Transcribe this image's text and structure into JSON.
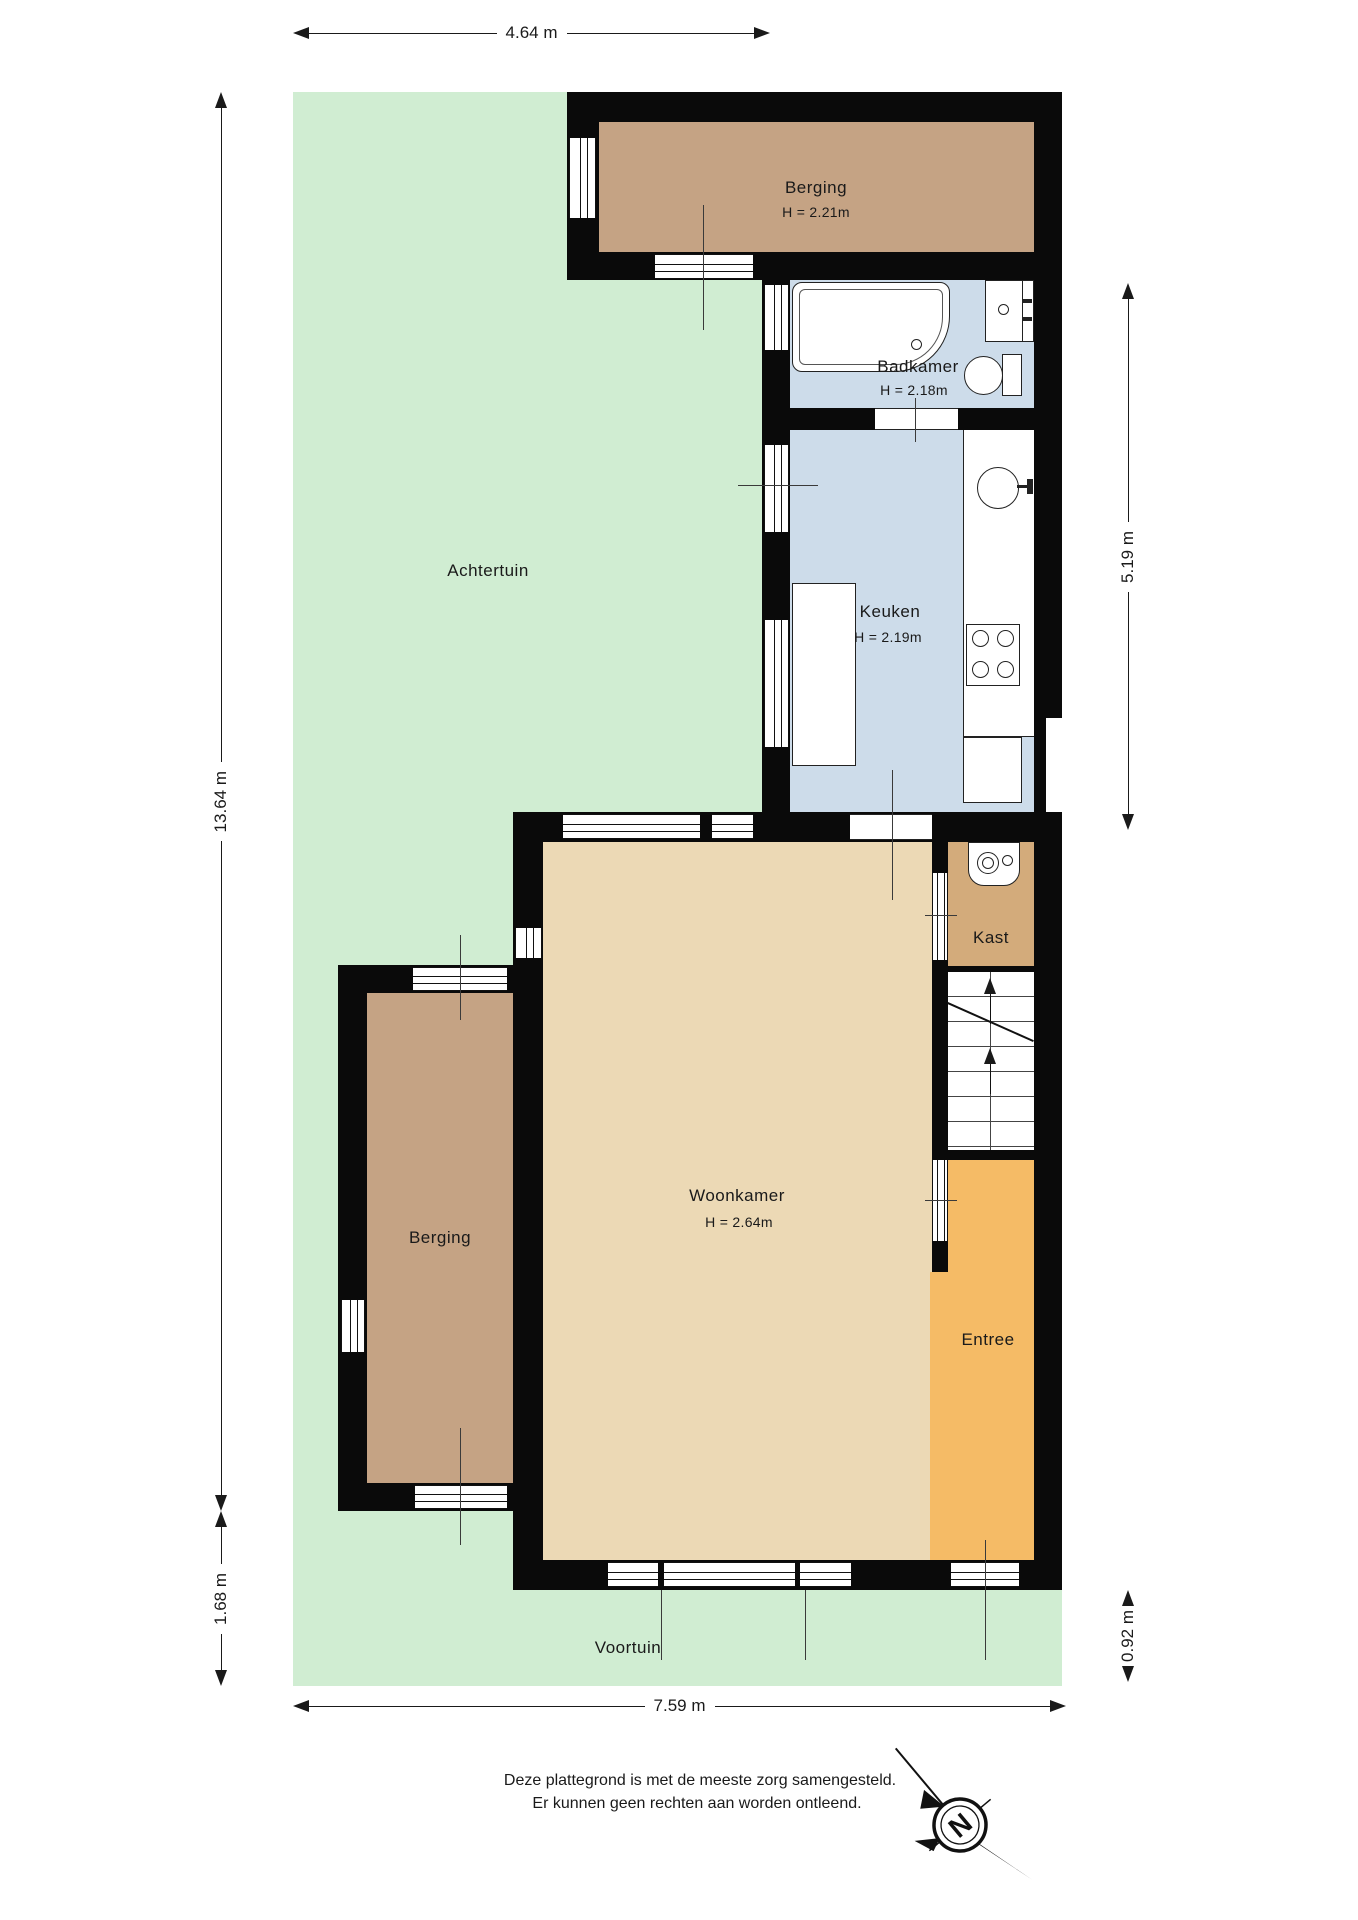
{
  "plan": {
    "rooms": {
      "berging_top": {
        "label": "Berging",
        "height": "H = 2.21m"
      },
      "badkamer": {
        "label": "Badkamer",
        "height": "H = 2.18m"
      },
      "keuken": {
        "label": "Keuken",
        "height": "H = 2.19m"
      },
      "achtertuin": {
        "label": "Achtertuin"
      },
      "woonkamer": {
        "label": "Woonkamer",
        "height": "H = 2.64m"
      },
      "kast": {
        "label": "Kast"
      },
      "berging_left": {
        "label": "Berging"
      },
      "entree": {
        "label": "Entree"
      },
      "voortuin": {
        "label": "Voortuin"
      }
    },
    "dimensions": {
      "top": "4.64 m",
      "left": "13.64 m",
      "left_bottom": "1.68 m",
      "right": "5.19 m",
      "right_bottom": "0.92 m",
      "bottom": "7.59 m"
    },
    "fixtures": [
      "bathtub",
      "washbasin",
      "toilet",
      "kitchen-sink",
      "stove",
      "kitchen-counter",
      "kitchen-island",
      "kitchen-cabinet",
      "washing-machine",
      "staircase"
    ],
    "compass": {
      "north_label": "N"
    },
    "footer": {
      "line1": "Deze plattegrond is met de meeste zorg samengesteld.",
      "line2": "Er kunnen geen rechten aan worden ontleend."
    },
    "colors": {
      "garden": "#d0edd2",
      "storage_tan": "#c5a384",
      "bath_kitchen_blue": "#cddcea",
      "living_beige": "#ecd9b5",
      "closet_tan": "#d3ab7b",
      "entry_orange": "#f5bb66",
      "walls": "#0a0a0a"
    }
  }
}
